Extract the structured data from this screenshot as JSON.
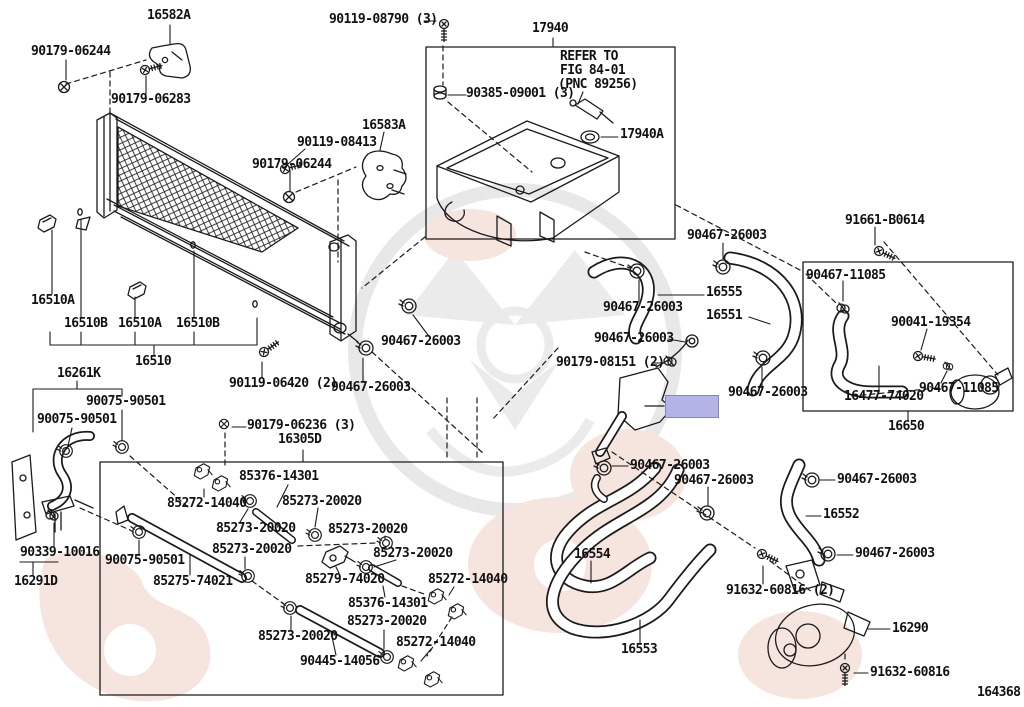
{
  "diagram": {
    "number": "164368",
    "colors": {
      "line": "#1a1a1a",
      "background": "#ffffff",
      "watermark_gray": "#e8e8e8",
      "watermark_pink": "#f6e4df",
      "highlight_fill": "#b3b3e6",
      "highlight_border": "#8183cc"
    },
    "highlight": {
      "x": 665,
      "y": 395,
      "w": 52,
      "h": 21
    },
    "group_boxes": [
      "17940",
      "16305D",
      "16650"
    ],
    "note": {
      "line1": "REFER TO",
      "line2": "FIG 84-01",
      "line3": "(PNC 89256)"
    },
    "callouts": [
      {
        "text": "16582A",
        "x": 147,
        "y": 10
      },
      {
        "text": "90179-06244",
        "x": 31,
        "y": 46
      },
      {
        "text": "90179-06283",
        "x": 111,
        "y": 94
      },
      {
        "text": "90119-08790 (3)",
        "x": 329,
        "y": 14
      },
      {
        "text": "17940",
        "x": 532,
        "y": 23
      },
      {
        "text": "REFER TO",
        "x": 560,
        "y": 51
      },
      {
        "text": "FIG 84-01",
        "x": 560,
        "y": 65
      },
      {
        "text": "(PNC 89256)",
        "x": 558,
        "y": 79
      },
      {
        "text": "90385-09001 (3)",
        "x": 466,
        "y": 88
      },
      {
        "text": "17940A",
        "x": 620,
        "y": 129
      },
      {
        "text": "16583A",
        "x": 362,
        "y": 120
      },
      {
        "text": "90119-08413",
        "x": 297,
        "y": 137
      },
      {
        "text": "90179-06244",
        "x": 252,
        "y": 159
      },
      {
        "text": "91661-B0614",
        "x": 845,
        "y": 215
      },
      {
        "text": "90467-26003",
        "x": 687,
        "y": 230
      },
      {
        "text": "90467-11085",
        "x": 806,
        "y": 270
      },
      {
        "text": "16555",
        "x": 706,
        "y": 287
      },
      {
        "text": "16551",
        "x": 706,
        "y": 310
      },
      {
        "text": "90467-26003",
        "x": 603,
        "y": 302
      },
      {
        "text": "90041-19354",
        "x": 891,
        "y": 317
      },
      {
        "text": "90467-26003",
        "x": 594,
        "y": 333
      },
      {
        "text": "90179-08151 (2)",
        "x": 556,
        "y": 357
      },
      {
        "text": "90467-26003",
        "x": 728,
        "y": 387
      },
      {
        "text": "90467-11085",
        "x": 919,
        "y": 383
      },
      {
        "text": "16477-74020",
        "x": 844,
        "y": 391
      },
      {
        "text": "16650",
        "x": 888,
        "y": 421
      },
      {
        "text": "90467-26003",
        "x": 381,
        "y": 336
      },
      {
        "text": "90119-06420 (2)",
        "x": 229,
        "y": 378
      },
      {
        "text": "90467-26003",
        "x": 331,
        "y": 382
      },
      {
        "text": "16510A",
        "x": 31,
        "y": 295
      },
      {
        "text": "16510B",
        "x": 64,
        "y": 318
      },
      {
        "text": "16510A",
        "x": 118,
        "y": 318
      },
      {
        "text": "16510B",
        "x": 176,
        "y": 318
      },
      {
        "text": "16510",
        "x": 135,
        "y": 356
      },
      {
        "text": "16261K",
        "x": 57,
        "y": 368
      },
      {
        "text": "90075-90501",
        "x": 86,
        "y": 396
      },
      {
        "text": "90075-90501",
        "x": 37,
        "y": 414
      },
      {
        "text": "90339-10016",
        "x": 20,
        "y": 547
      },
      {
        "text": "16291D",
        "x": 14,
        "y": 576
      },
      {
        "text": "90075-90501",
        "x": 105,
        "y": 555
      },
      {
        "text": "85275-74021",
        "x": 153,
        "y": 576
      },
      {
        "text": "90179-06236 (3)",
        "x": 247,
        "y": 420
      },
      {
        "text": "16305D",
        "x": 278,
        "y": 434
      },
      {
        "text": "85376-14301",
        "x": 239,
        "y": 471
      },
      {
        "text": "85272-14040",
        "x": 167,
        "y": 498
      },
      {
        "text": "85273-20020",
        "x": 282,
        "y": 496
      },
      {
        "text": "85273-20020",
        "x": 216,
        "y": 523
      },
      {
        "text": "85273-20020",
        "x": 328,
        "y": 524
      },
      {
        "text": "85273-20020",
        "x": 212,
        "y": 544
      },
      {
        "text": "85273-20020",
        "x": 373,
        "y": 548
      },
      {
        "text": "85279-74020",
        "x": 305,
        "y": 574
      },
      {
        "text": "85272-14040",
        "x": 428,
        "y": 574
      },
      {
        "text": "85376-14301",
        "x": 348,
        "y": 598
      },
      {
        "text": "85273-20020",
        "x": 347,
        "y": 616
      },
      {
        "text": "85273-20020",
        "x": 258,
        "y": 631
      },
      {
        "text": "85272-14040",
        "x": 396,
        "y": 637
      },
      {
        "text": "90445-14056",
        "x": 300,
        "y": 656
      },
      {
        "text": "16554",
        "x": 574,
        "y": 549
      },
      {
        "text": "16553",
        "x": 621,
        "y": 644
      },
      {
        "text": "90467-26003",
        "x": 630,
        "y": 460
      },
      {
        "text": "90467-26003",
        "x": 674,
        "y": 475
      },
      {
        "text": "90467-26003",
        "x": 837,
        "y": 474
      },
      {
        "text": "16552",
        "x": 823,
        "y": 509
      },
      {
        "text": "90467-26003",
        "x": 855,
        "y": 548
      },
      {
        "text": "91632-60816 (2)",
        "x": 726,
        "y": 585
      },
      {
        "text": "16290",
        "x": 892,
        "y": 623
      },
      {
        "text": "91632-60816",
        "x": 870,
        "y": 667
      }
    ]
  }
}
